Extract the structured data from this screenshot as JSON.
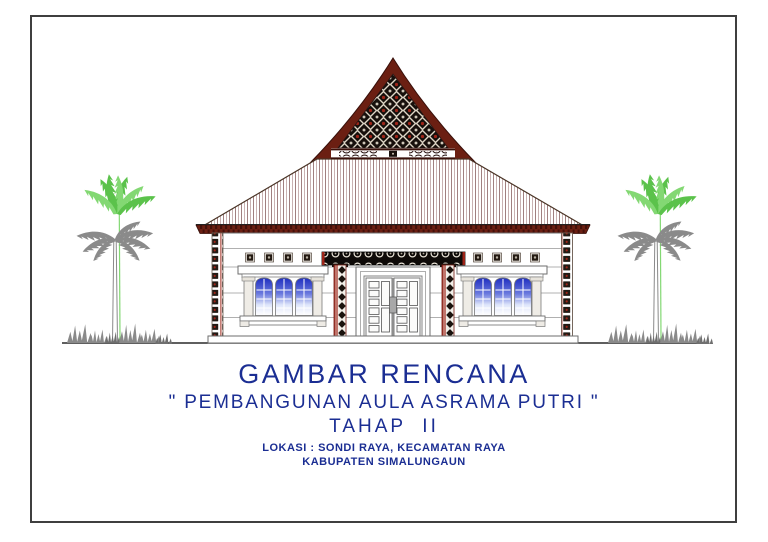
{
  "caption": {
    "title": "GAMBAR RENCANA",
    "subtitle": "\" PEMBANGUNAN AULA ASRAMA PUTRI \"",
    "phase": "TAHAP  II",
    "location1": "LOKASI : SONDI RAYA, KECAMATAN RAYA",
    "location2": "KABUPATEN SIMALUNGAUN"
  },
  "drawing": {
    "subject": "front-elevation-of-hall-building-with-traditional-simalungun-gable-ornament",
    "elements": [
      "ornamental-gable-roof",
      "striped-hip-roof",
      "double-panel-door",
      "arched-window-left",
      "arched-window-right",
      "gorga-ornament-columns",
      "palm-tree-left",
      "palm-tree-right",
      "ground-line"
    ]
  },
  "colors": {
    "page-bg": "#ffffff",
    "frame-border": "#3f3f3f",
    "text-blue": "#1b2e93",
    "roof-maroon": "#6b1f12",
    "roof-edge": "#38100a",
    "roof-stripe-a": "#a18080",
    "roof-stripe-b": "#c9b2b2",
    "ornament-dark": "#17100c",
    "ornament-red": "#9e2418",
    "glass-blue": "#1f2ec0",
    "leaf-green": "#5bc24b",
    "leaf-green-light": "#83d873",
    "tree-gray": "#8a8a8a",
    "wall-line": "#b0b0b0",
    "outline-gray": "#6e6e6e",
    "ground-dark": "#2a2a2a"
  }
}
